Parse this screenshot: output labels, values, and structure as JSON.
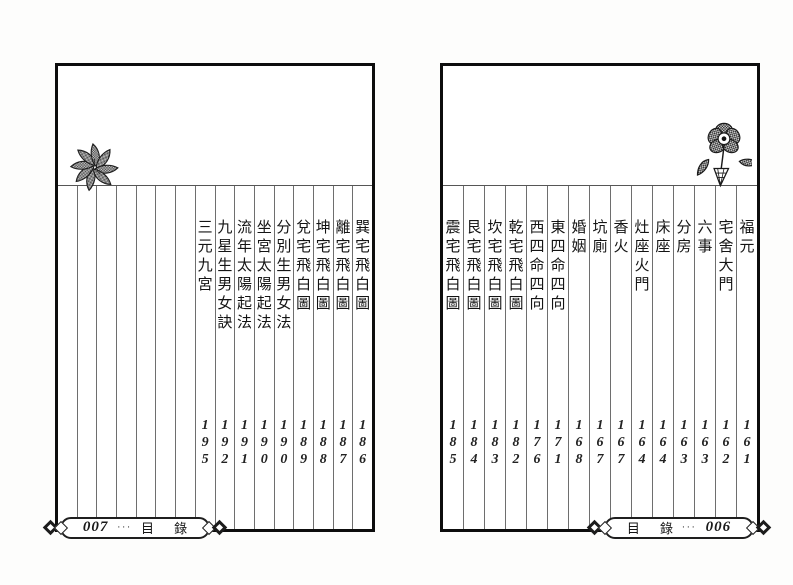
{
  "document": {
    "kind": "scanned-book-toc",
    "language": "zh-Hant"
  },
  "colors": {
    "page_background": "#ffffff",
    "sheet_border": "#0d0d0d",
    "grid_line": "#6e6e6e",
    "text": "#1a1a1a"
  },
  "pages": [
    {
      "side": "left",
      "folio_number": "007",
      "folio_dots": "···",
      "folio_title": "目 錄",
      "ornament": "leaf-cluster-icon",
      "empty_columns": 7,
      "entries": [
        {
          "title": "巽宅飛白圖",
          "page": "186"
        },
        {
          "title": "離宅飛白圖",
          "page": "187"
        },
        {
          "title": "坤宅飛白圖",
          "page": "188"
        },
        {
          "title": "兌宅飛白圖",
          "page": "189"
        },
        {
          "title": "分別生男女法",
          "page": "190"
        },
        {
          "title": "坐宮太陽起法",
          "page": "190"
        },
        {
          "title": "流年太陽起法",
          "page": "191"
        },
        {
          "title": "九星生男女訣",
          "page": "192"
        },
        {
          "title": "三元九宮",
          "page": "195"
        }
      ]
    },
    {
      "side": "right",
      "folio_number": "006",
      "folio_dots": "···",
      "folio_title": "目 錄",
      "ornament": "rose-flower-icon",
      "empty_columns": 0,
      "entries": [
        {
          "title": "福元",
          "page": "161"
        },
        {
          "title": "宅舍大門",
          "page": "162"
        },
        {
          "title": "六事",
          "page": "163"
        },
        {
          "title": "分房",
          "page": "163"
        },
        {
          "title": "床座",
          "page": "164"
        },
        {
          "title": "灶座火門",
          "page": "164"
        },
        {
          "title": "香火",
          "page": "167"
        },
        {
          "title": "坑廁",
          "page": "167"
        },
        {
          "title": "婚姻",
          "page": "168"
        },
        {
          "title": "東四命四向",
          "page": "171"
        },
        {
          "title": "西四命四向",
          "page": "176"
        },
        {
          "title": "乾宅飛白圖",
          "page": "182"
        },
        {
          "title": "坎宅飛白圖",
          "page": "183"
        },
        {
          "title": "艮宅飛白圖",
          "page": "184"
        },
        {
          "title": "震宅飛白圖",
          "page": "185"
        }
      ]
    }
  ]
}
